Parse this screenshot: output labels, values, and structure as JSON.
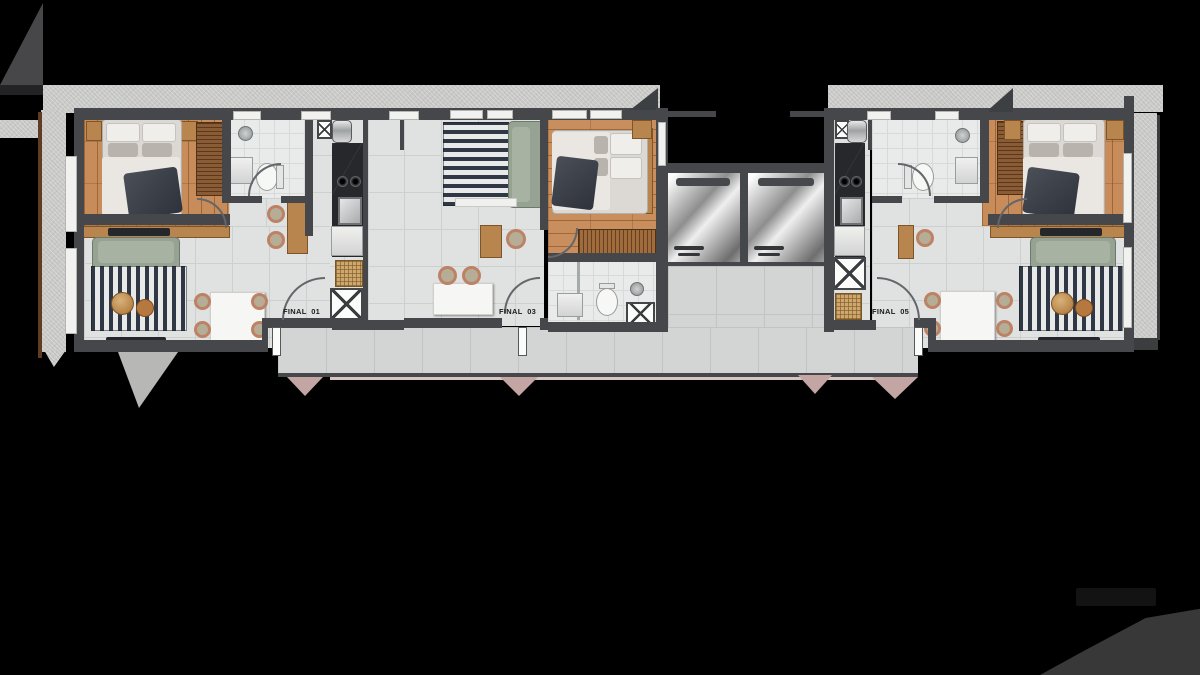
{
  "scene": {
    "type": "architectural-floor-plan",
    "description": "Top-view rendered floor plan of three studio apartment units connected by a corridor with two elevators, on black background",
    "background": "#000000"
  },
  "units": [
    {
      "id": "01",
      "entry_label": "FINAL  01"
    },
    {
      "id": "03",
      "entry_label": "FINAL  03"
    },
    {
      "id": "05",
      "entry_label": "FINAL  05"
    }
  ],
  "palette": {
    "wall_dark": "#45474a",
    "concrete_light": "#c8c9c7",
    "unit_tile": "#e0e2e1",
    "bath_tile": "#e9ebea",
    "corridor_tile": "#d2d5d4",
    "wood_floor": "#c88c5b",
    "furniture_wood": "#b9854f",
    "sofa_green": "#96a292",
    "rug_navy": "#2f3844",
    "rug_white": "#e8e9e9",
    "counter_dark": "#26282b",
    "entry_marker_rose": "#c3a6a4",
    "elevator_metal_hi": "#fcfcfc",
    "elevator_metal_lo": "#6e6e6e",
    "label_text": "#191a1c",
    "watermark_gray": "#383838"
  }
}
